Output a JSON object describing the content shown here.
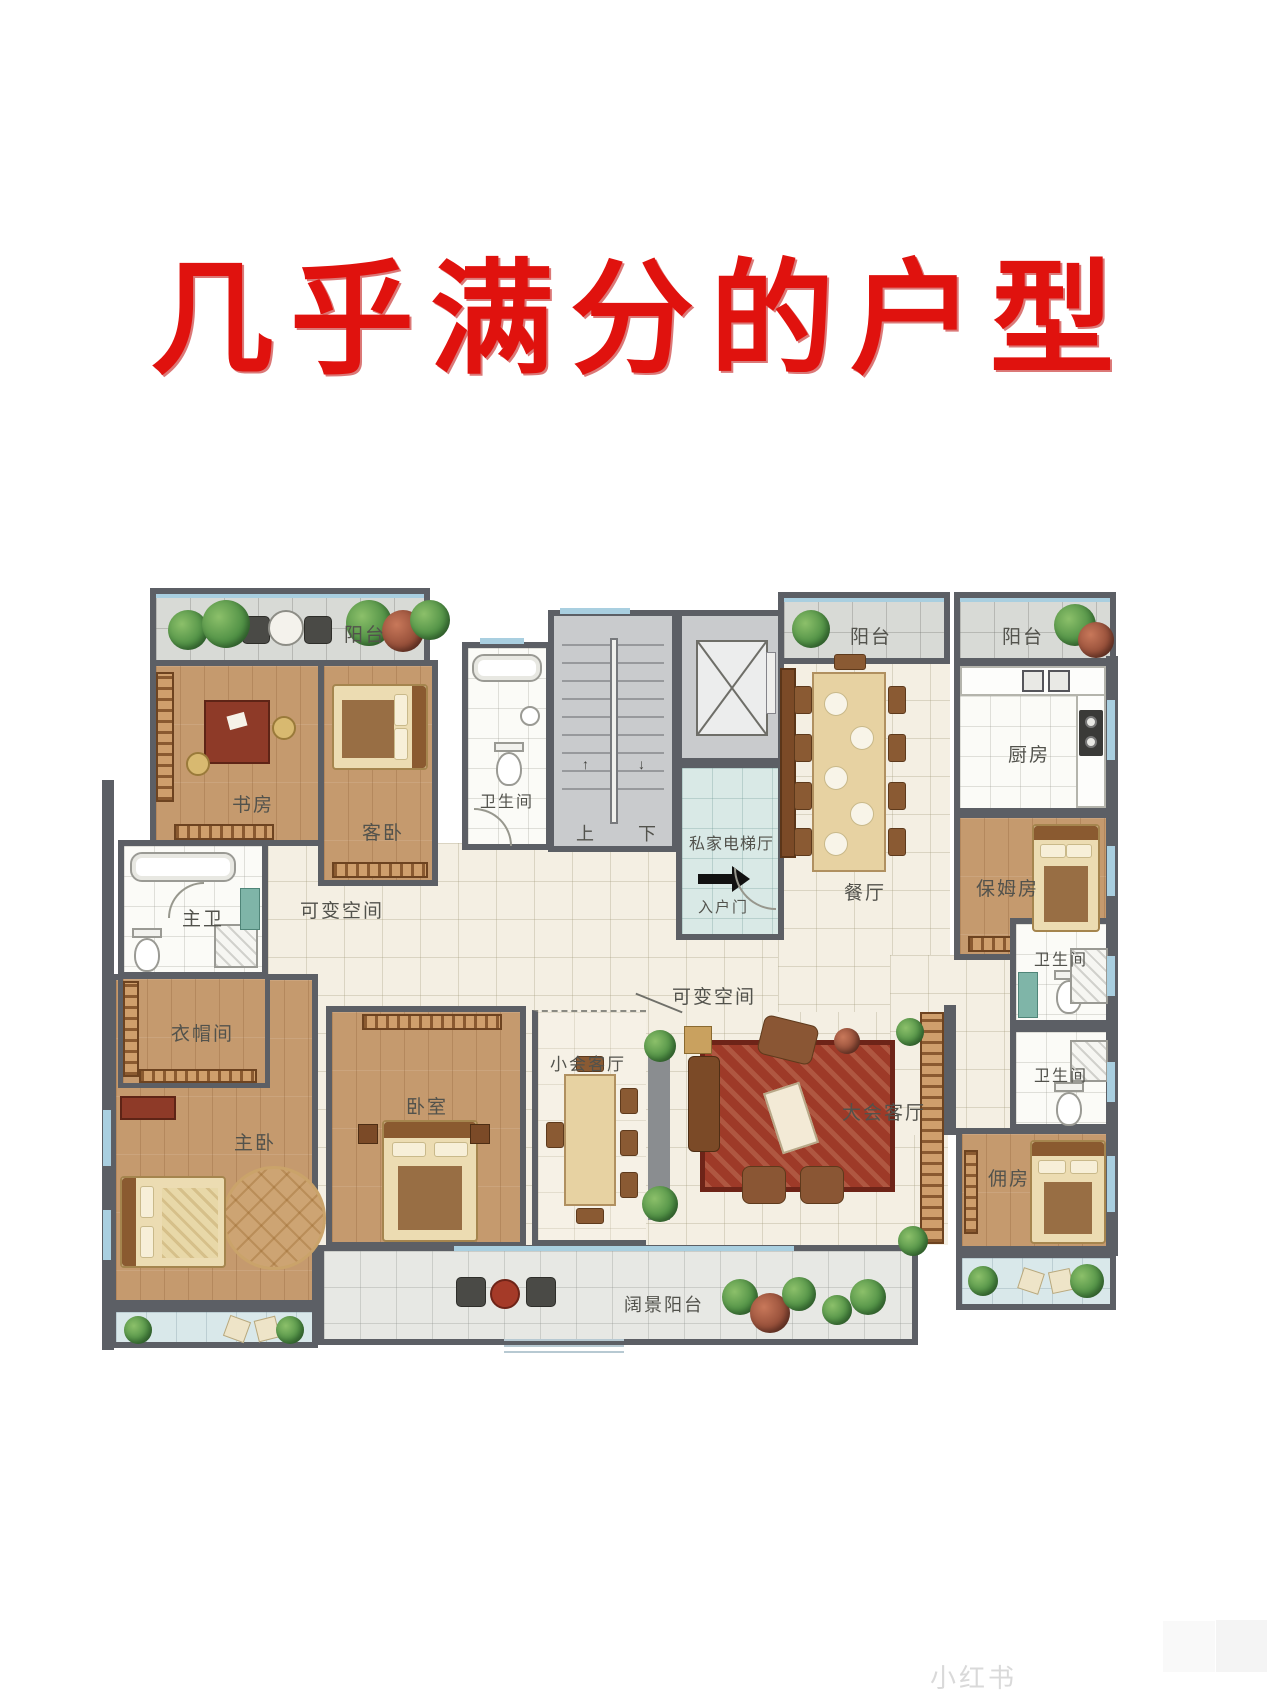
{
  "title": "几乎满分的户型",
  "colors": {
    "title_red": "#e0120e",
    "wall": "#5c5f65",
    "wood_floor": "#c59a6e",
    "tile_cream": "#f4efe3",
    "glass_blue": "#a9cfe0"
  },
  "rooms": {
    "balcony_tl": "阳台",
    "study": "书房",
    "guest_bedroom": "客卧",
    "bath_upper": "卫生间",
    "stairs_up": "上",
    "stairs_down": "下",
    "elevator_hall": "私家电梯厅",
    "entry_door": "入户门",
    "balcony_tr1": "阳台",
    "balcony_tr2": "阳台",
    "kitchen": "厨房",
    "dining": "餐厅",
    "nanny_room": "保姆房",
    "master_bath": "主卫",
    "flex_left": "可变空间",
    "flex_center": "可变空间",
    "cloakroom": "衣帽间",
    "master_bedroom": "主卧",
    "bedroom": "卧室",
    "small_lounge": "小会客厅",
    "grand_lounge": "大会客厅",
    "bath_right_top": "卫生间",
    "bath_right_bottom": "卫生间",
    "maid_room": "佣房",
    "view_balcony": "阔景阳台"
  },
  "watermark": "小红书"
}
